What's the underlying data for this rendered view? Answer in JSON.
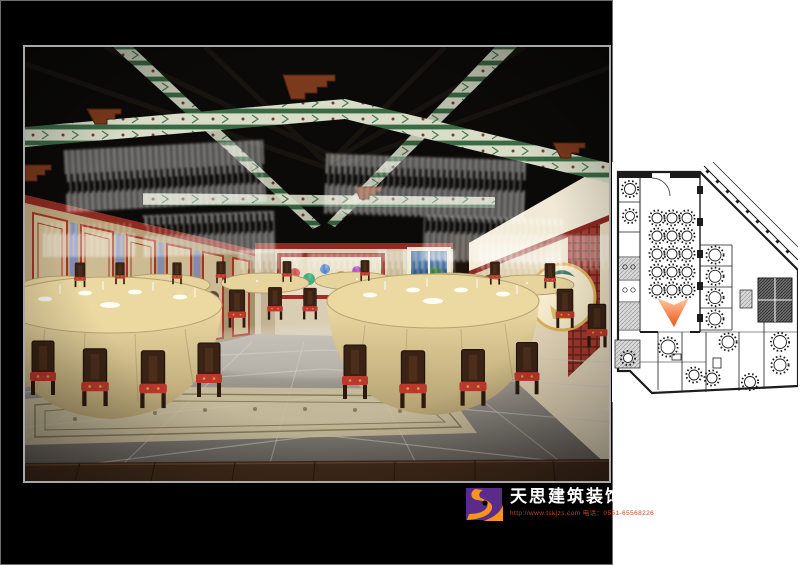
{
  "branding": {
    "company_name": "天思建筑装饰",
    "contact_line": "http://www.tskjzs.com 电话：0551-65568226",
    "colors": {
      "purple": "#5b2b8c",
      "orange": "#f7941d",
      "dot": "#000000",
      "name_text": "#ffffff",
      "contact_text": "#c2481f"
    }
  },
  "board": {
    "background": "#000000",
    "frame_border": "#6e6e6e",
    "photo_border": "#a8a8a8"
  },
  "floor_plan": {
    "ink": "#1c1c1c",
    "paper": "#ffffff",
    "hall_tables": {
      "rows": 5,
      "cols": 3
    },
    "stall_tables": {
      "count": 4
    },
    "room_tables": [
      [
        56,
        185,
        7
      ],
      [
        116,
        180,
        6
      ],
      [
        168,
        180,
        6.5
      ],
      [
        82,
        213,
        5
      ],
      [
        100,
        216,
        5
      ],
      [
        138,
        220,
        5.5
      ],
      [
        168,
        203,
        6
      ],
      [
        16,
        196,
        4.5
      ],
      [
        18,
        27,
        5.5
      ],
      [
        18,
        54,
        4.5
      ]
    ],
    "marker": {
      "name": "view-direction-cone",
      "color_top": "#ffc9a0",
      "color_tip": "#ee5418"
    }
  },
  "scene": {
    "palette": {
      "ceiling": "#0b0a08",
      "beam_green": "#3a6a44",
      "beam_cream": "#d8dcc8",
      "corbel": "#7c3a1c",
      "wall_beige": "#c9b48f",
      "wall_red": "#9e2f28",
      "tablecloth": "#e6d49c",
      "cushion": "#bb392c",
      "floor_grey": "#8d8880",
      "wood_floor": "#452d1c",
      "carpet": "#cdc19e",
      "window_sky": "#1d3f6e"
    }
  }
}
